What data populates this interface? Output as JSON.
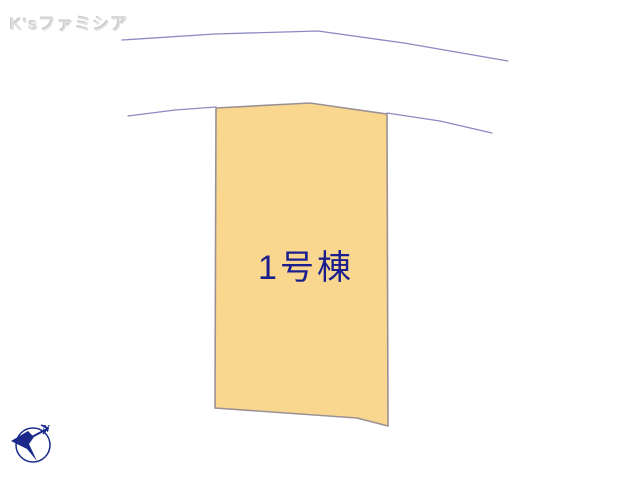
{
  "watermark": {
    "text": "K'sファミシア",
    "color": "#dedede"
  },
  "plan": {
    "background": "#ffffff",
    "road_color": "#8b8bc2",
    "roads": [
      {
        "name": "upper-road-line",
        "points": [
          [
            122,
            40
          ],
          [
            215,
            34
          ],
          [
            318,
            31
          ],
          [
            404,
            43
          ],
          [
            508,
            61
          ]
        ]
      },
      {
        "name": "lower-road-line-left",
        "points": [
          [
            128,
            116
          ],
          [
            175,
            110
          ],
          [
            216,
            107
          ]
        ]
      },
      {
        "name": "lower-road-line-right",
        "points": [
          [
            387,
            113
          ],
          [
            440,
            121
          ],
          [
            492,
            133
          ]
        ]
      }
    ],
    "lot": {
      "label": "1号棟",
      "fill": "#f9d78e",
      "stroke": "#9b9195",
      "label_color": "#1b1f8e",
      "label_x": 306,
      "label_y": 279,
      "points": [
        [
          216,
          108
        ],
        [
          310,
          103
        ],
        [
          387,
          114
        ],
        [
          388,
          426
        ],
        [
          357,
          418
        ],
        [
          215,
          408
        ]
      ]
    }
  },
  "compass": {
    "n_label": "N",
    "color": "#1b2a8a"
  }
}
